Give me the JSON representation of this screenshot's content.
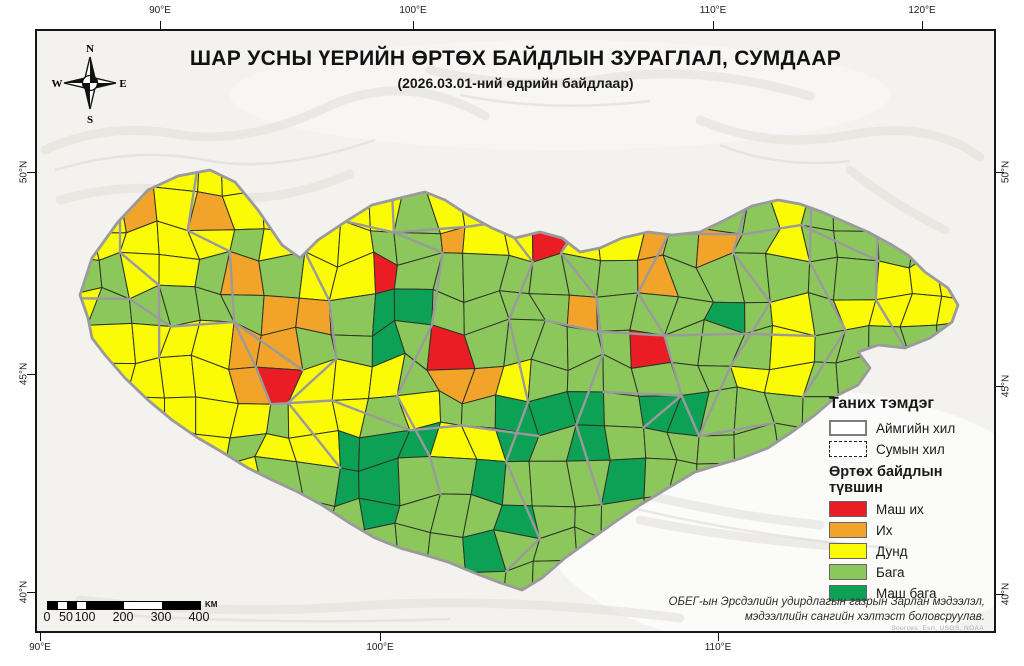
{
  "title": "ШАР УСНЫ ҮЕРИЙН ӨРТӨХ БАЙДЛЫН ЗУРАГЛАЛ, СУМДААР",
  "subtitle": "(2026.03.01-ний өдрийн байдлаар)",
  "compass": {
    "n": "N",
    "e": "E",
    "s": "S",
    "w": "W"
  },
  "graticule": {
    "top": [
      {
        "label": "90°E",
        "x": 160
      },
      {
        "label": "100°E",
        "x": 413
      },
      {
        "label": "110°E",
        "x": 713
      },
      {
        "label": "120°E",
        "x": 922
      }
    ],
    "bottom": [
      {
        "label": "90°E",
        "x": 40
      },
      {
        "label": "100°E",
        "x": 380
      },
      {
        "label": "110°E",
        "x": 718
      }
    ],
    "left": [
      {
        "label": "50°N",
        "y": 172
      },
      {
        "label": "45°N",
        "y": 374
      },
      {
        "label": "40°N",
        "y": 592
      }
    ],
    "right": [
      {
        "label": "50°N",
        "y": 172
      },
      {
        "label": "45°N",
        "y": 386
      },
      {
        "label": "40°N",
        "y": 594
      }
    ]
  },
  "legend": {
    "title": "Таних тэмдэг",
    "boundary_items": [
      {
        "label": "Аймгийн хил",
        "style": "solid"
      },
      {
        "label": "Сумын хил",
        "style": "dashdot"
      }
    ],
    "levels_title": "Өртөх байдлын түвшин",
    "levels": [
      {
        "label": "Маш их",
        "color": "#EA1C24"
      },
      {
        "label": "Их",
        "color": "#F2A42A"
      },
      {
        "label": "Дунд",
        "color": "#FBFB05"
      },
      {
        "label": "Бага",
        "color": "#8CC75C"
      },
      {
        "label": "Маш бага",
        "color": "#0CA154"
      }
    ]
  },
  "scalebar": {
    "labels": [
      "0",
      "50",
      "100",
      "200",
      "300",
      "400"
    ],
    "km_positions": [
      0,
      50,
      100,
      200,
      300,
      400
    ],
    "unit": "KM",
    "px_per_km": 0.38
  },
  "attribution": {
    "line1": "ОБЕГ-ын Эрсдэлийн удирдлагын газрын Зарлан мэдээлэл,",
    "line2": "мэдээллийн сангийн хэлтэст боловсруулав."
  },
  "basemap_credit": "Sources: Esri, USGS, NOAA",
  "map": {
    "class_colors": {
      "R": "#EA1C24",
      "O": "#F2A42A",
      "Y": "#FBFB05",
      "G": "#8CC75C",
      "D": "#0CA154"
    },
    "soum_border_color": "#2E3328",
    "aymag_border_color": "#9A9A9C",
    "outline": [
      [
        88,
        318
      ],
      [
        80,
        295
      ],
      [
        92,
        258
      ],
      [
        118,
        222
      ],
      [
        148,
        190
      ],
      [
        178,
        176
      ],
      [
        210,
        170
      ],
      [
        235,
        182
      ],
      [
        258,
        210
      ],
      [
        282,
        245
      ],
      [
        300,
        258
      ],
      [
        318,
        240
      ],
      [
        345,
        222
      ],
      [
        372,
        205
      ],
      [
        400,
        198
      ],
      [
        425,
        192
      ],
      [
        445,
        200
      ],
      [
        468,
        215
      ],
      [
        492,
        228
      ],
      [
        515,
        238
      ],
      [
        540,
        232
      ],
      [
        562,
        238
      ],
      [
        580,
        252
      ],
      [
        600,
        248
      ],
      [
        622,
        238
      ],
      [
        648,
        232
      ],
      [
        672,
        235
      ],
      [
        700,
        232
      ],
      [
        725,
        220
      ],
      [
        752,
        206
      ],
      [
        778,
        200
      ],
      [
        800,
        204
      ],
      [
        822,
        212
      ],
      [
        845,
        222
      ],
      [
        868,
        232
      ],
      [
        892,
        245
      ],
      [
        908,
        255
      ],
      [
        925,
        272
      ],
      [
        948,
        288
      ],
      [
        958,
        305
      ],
      [
        952,
        322
      ],
      [
        930,
        338
      ],
      [
        905,
        348
      ],
      [
        878,
        345
      ],
      [
        858,
        352
      ],
      [
        870,
        368
      ],
      [
        858,
        385
      ],
      [
        838,
        395
      ],
      [
        815,
        415
      ],
      [
        792,
        432
      ],
      [
        768,
        448
      ],
      [
        742,
        458
      ],
      [
        718,
        465
      ],
      [
        695,
        472
      ],
      [
        668,
        488
      ],
      [
        640,
        505
      ],
      [
        615,
        522
      ],
      [
        590,
        540
      ],
      [
        565,
        558
      ],
      [
        542,
        578
      ],
      [
        522,
        590
      ],
      [
        498,
        582
      ],
      [
        472,
        572
      ],
      [
        448,
        562
      ],
      [
        425,
        555
      ],
      [
        400,
        548
      ],
      [
        375,
        538
      ],
      [
        348,
        522
      ],
      [
        322,
        505
      ],
      [
        298,
        492
      ],
      [
        272,
        480
      ],
      [
        248,
        468
      ],
      [
        222,
        452
      ],
      [
        198,
        438
      ],
      [
        172,
        420
      ],
      [
        148,
        400
      ],
      [
        125,
        378
      ],
      [
        105,
        355
      ],
      [
        92,
        338
      ]
    ],
    "grid": {
      "x0": 60,
      "y0": 158,
      "cell": 34,
      "cols": 27,
      "rows": 13,
      "rowcodes": [
        "YYYYYYYYYYYYYYYYYYYYYYYYYYY",
        "YYOYOYYYYYGYYOOYYGGGGYGGGYY",
        "YYYYYGYYYGGOYYRYYOGOGYGGGGY",
        "GGYYGOGYYRGGGGGGGOGGGGGGYYY",
        "YGGGGGOOGDDGGGGOGGGDGYGYYYY",
        "YYYYYOOGGDGRGGGGGRGGGYGGGGG",
        "YYYYYORYYYGOOYGGGGGGYYGGGGG",
        "YYYYYYGYYGYGGDDDGDDGGGGGGGG",
        "YYYYYGYYDDDYYDGDGGGGGGGGGGG",
        "YYYYYYGGDDGGDGGGDGGGGGGGGGG",
        "YYYYYYYGGDGGGDGGGGGGGGGGGGG",
        "GGGGGGGGGGGGDGGGGGGGGGGGGGG",
        "GGGGGGGGGGGGGGGGGGGGGGGGGGG"
      ]
    },
    "aymag_borders": [
      [
        [
          2,
          1
        ],
        [
          2,
          3
        ],
        [
          3,
          4
        ],
        [
          3,
          6
        ]
      ],
      [
        [
          4,
          0
        ],
        [
          4,
          2
        ],
        [
          5,
          3
        ],
        [
          5,
          5
        ],
        [
          6,
          6
        ],
        [
          6,
          7
        ]
      ],
      [
        [
          7,
          1
        ],
        [
          7,
          3
        ],
        [
          8,
          4
        ],
        [
          8,
          6
        ],
        [
          7,
          7
        ],
        [
          8,
          9
        ]
      ],
      [
        [
          10,
          0
        ],
        [
          10,
          2
        ],
        [
          11,
          3
        ],
        [
          11,
          5
        ],
        [
          10,
          7
        ],
        [
          11,
          9
        ],
        [
          11,
          10
        ]
      ],
      [
        [
          13,
          0
        ],
        [
          13,
          2
        ],
        [
          14,
          3
        ],
        [
          13,
          5
        ],
        [
          14,
          7
        ],
        [
          13,
          9
        ],
        [
          14,
          11
        ],
        [
          13,
          12
        ]
      ],
      [
        [
          16,
          1
        ],
        [
          15,
          3
        ],
        [
          16,
          4
        ],
        [
          16,
          6
        ],
        [
          15,
          8
        ],
        [
          16,
          10
        ]
      ],
      [
        [
          18,
          0
        ],
        [
          18,
          2
        ],
        [
          17,
          4
        ],
        [
          18,
          5
        ],
        [
          18,
          7
        ],
        [
          17,
          8
        ]
      ],
      [
        [
          20,
          1
        ],
        [
          20,
          3
        ],
        [
          21,
          4
        ],
        [
          20,
          6
        ],
        [
          19,
          8
        ]
      ],
      [
        [
          22,
          1
        ],
        [
          22,
          3
        ],
        [
          23,
          5
        ],
        [
          22,
          7
        ]
      ],
      [
        [
          24,
          2
        ],
        [
          24,
          4
        ],
        [
          25,
          6
        ]
      ],
      [
        [
          0,
          4
        ],
        [
          2,
          4
        ],
        [
          3,
          5
        ],
        [
          5,
          5
        ],
        [
          7,
          6
        ]
      ],
      [
        [
          14,
          5
        ],
        [
          16,
          5
        ],
        [
          18,
          5
        ],
        [
          20,
          5
        ],
        [
          22,
          5
        ]
      ],
      [
        [
          6,
          7
        ],
        [
          8,
          7
        ],
        [
          10,
          8
        ],
        [
          12,
          8
        ],
        [
          14,
          8
        ]
      ],
      [
        [
          16,
          7
        ],
        [
          18,
          7
        ],
        [
          19,
          8
        ],
        [
          21,
          8
        ]
      ],
      [
        [
          8,
          2
        ],
        [
          10,
          2
        ],
        [
          12,
          2
        ],
        [
          13,
          2
        ]
      ],
      [
        [
          18,
          2
        ],
        [
          20,
          2
        ],
        [
          22,
          2
        ],
        [
          24,
          3
        ]
      ]
    ]
  }
}
